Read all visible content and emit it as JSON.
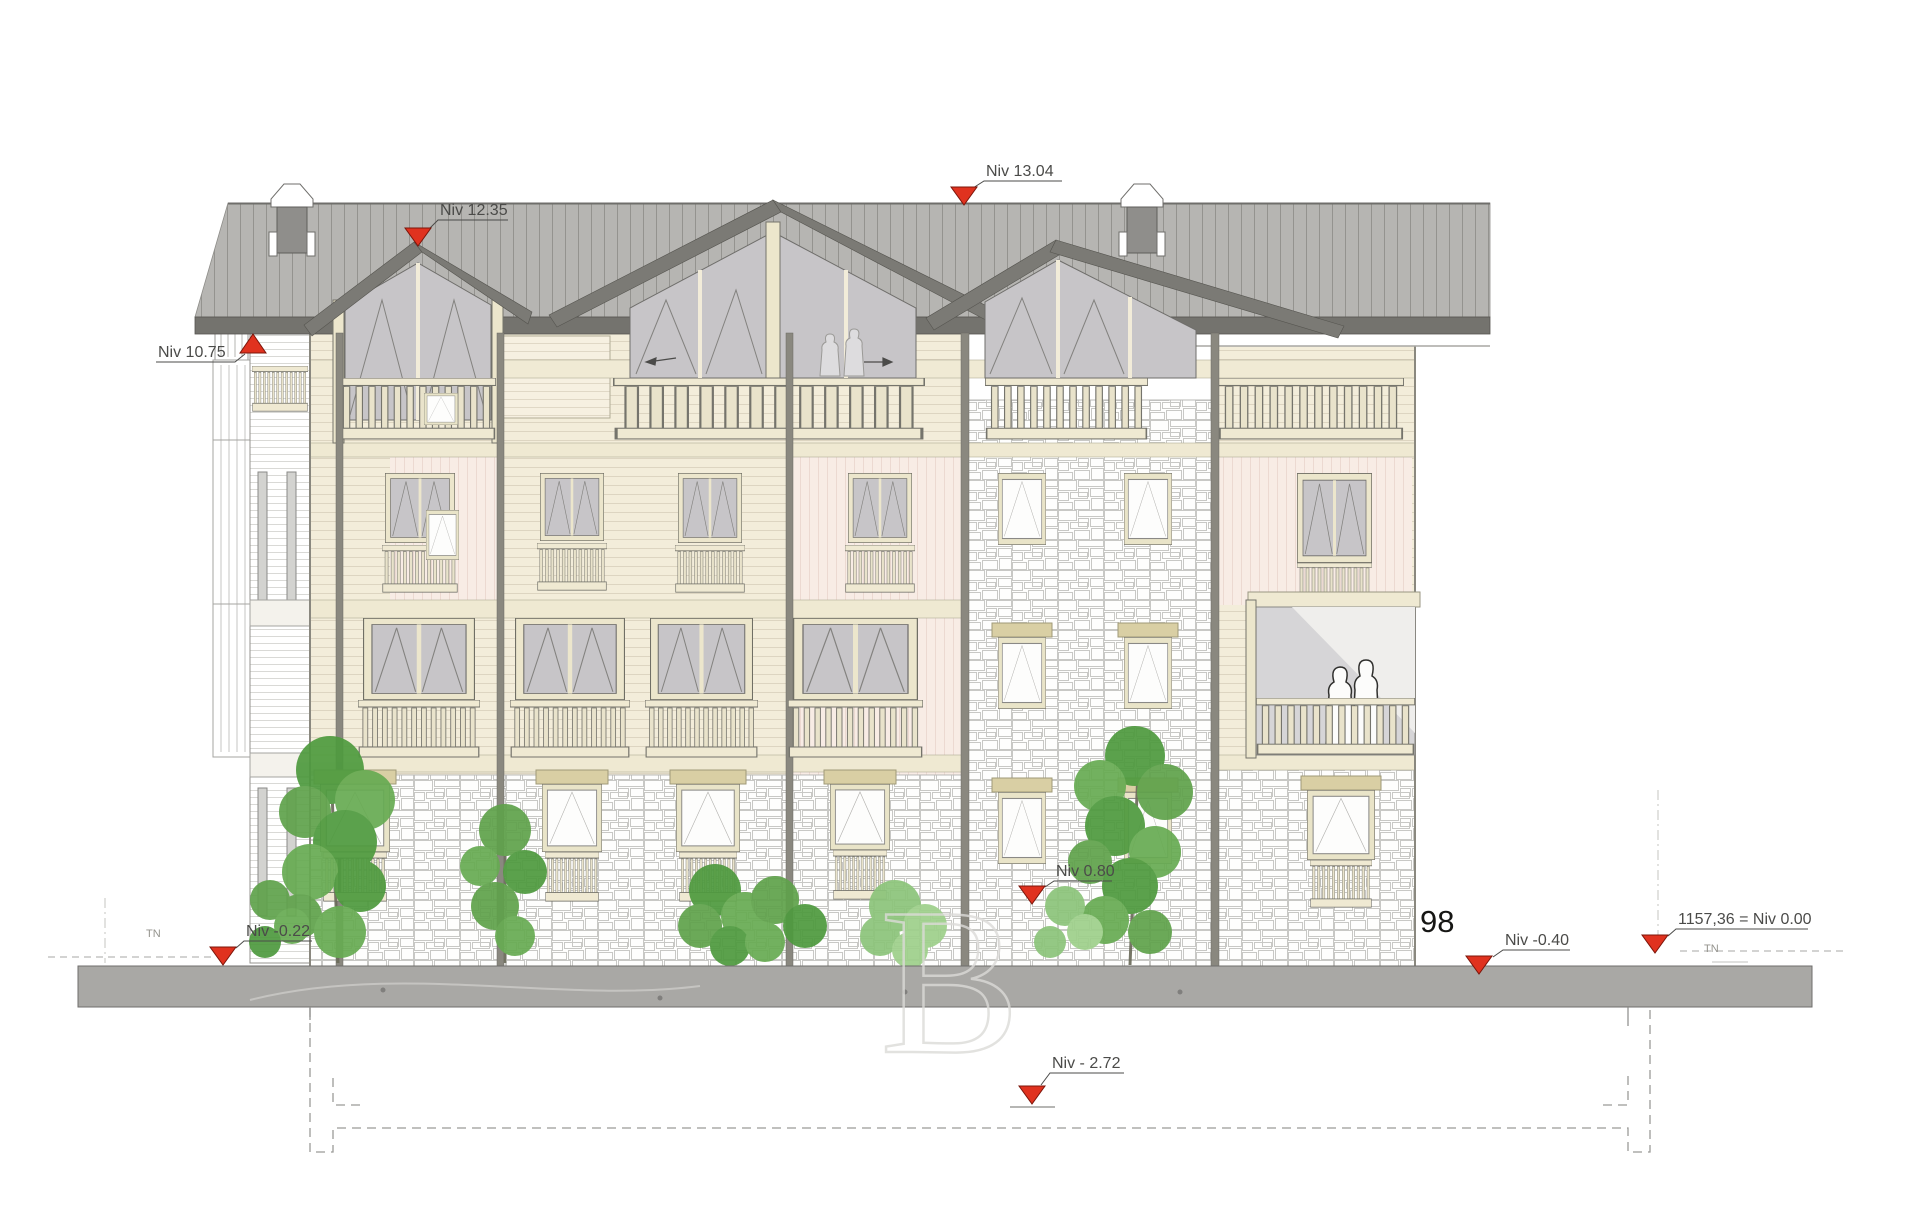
{
  "document": {
    "kind": "architectural elevation drawing",
    "paper_color": "#ffffff"
  },
  "annotations": {
    "levels": [
      {
        "id": "ridge",
        "label": "Niv 13.04",
        "marker": "down-triangle"
      },
      {
        "id": "gable-peak",
        "label": "Niv 12.35",
        "marker": "down-triangle"
      },
      {
        "id": "eave",
        "label": "Niv 10.75",
        "marker": "up-triangle"
      },
      {
        "id": "rear-ground",
        "label": "Niv 0.80",
        "marker": "down-triangle"
      },
      {
        "id": "terrain-left",
        "label": "Niv -0.22",
        "marker": "down-triangle"
      },
      {
        "id": "terrain-right",
        "label": "Niv -0.40",
        "marker": "down-triangle"
      },
      {
        "id": "datum",
        "label": "1157,36 = Niv 0.00",
        "marker": "down-triangle"
      },
      {
        "id": "basement",
        "label": "Niv - 2.72",
        "marker": "down-triangle"
      }
    ],
    "terrain_marks": {
      "left": "TN",
      "right": "TN"
    },
    "parcel_number": "98",
    "watermark_letter": "B"
  },
  "palette": {
    "marker_red": "#e0321f",
    "roof_gray": "#b6b5b2",
    "eave_gray": "#74736e",
    "wood_cream": "#f3edda",
    "trim_cream": "#efe9d2",
    "siding_pink": "#f8ece5",
    "stone_joint": "#c8c8c5",
    "post_gray": "#8a887f",
    "glass_gray": "#c7c5c8",
    "ground_gray": "#a9a8a5",
    "foliage_green": "#5fa24b",
    "label_text": "#4b4b49"
  }
}
